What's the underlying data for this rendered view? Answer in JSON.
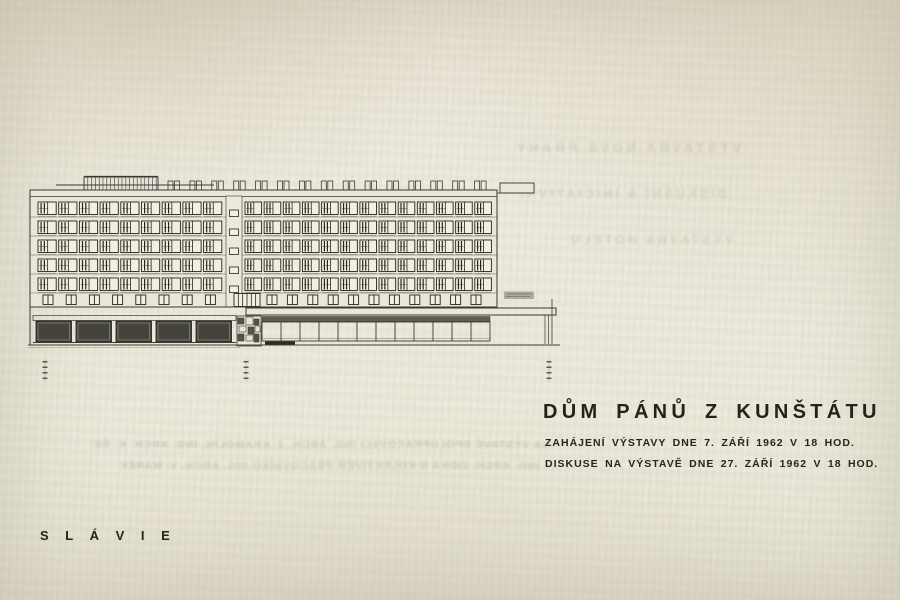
{
  "document": {
    "title": "DŮM PÁNŮ Z KUNŠTÁTU",
    "subtitle_lines": [
      "ZAHÁJENÍ VÝSTAVY DNE 7. ZÁŘÍ 1962 V 18 HOD.",
      "DISKUSE NA VÝSTAVĚ DNE 27. ZÁŘÍ 1962 V 18 HOD."
    ],
    "footer_label": "S L Á V I E"
  },
  "bleedthrough": {
    "top_lines": [
      "VÝSTAVBA NOVÉ PRAHY",
      "DISKUSNÍ A INICIATIVNÍ",
      "VÝSTAVBA HOTELU"
    ],
    "bottom_lines": [
      "NA VÝSTAVĚ SPOLUPRACOVALI ING. ARCH. J. KRAMOLÍN, ING. ARCH. K. ŘEPA,",
      "ING. ARCH. ZÍDKA S KOLEKTIVEM PRACOVNÍKŮ ING. ARCH. V. MAREK"
    ]
  },
  "drawing": {
    "subject": "building-elevation-hotel-slavie",
    "floors": 5,
    "left_windows": 9,
    "right_windows": 13,
    "shaft_windows": 5,
    "mezzanine_left": 8,
    "mezzanine_right": 11,
    "storefronts": 5,
    "arcade_bays": 12,
    "roof_vent_pairs": 15,
    "entrance_mullions": 5,
    "dimension_marks_x": [
      45,
      246,
      549
    ],
    "colors": {
      "line": "#3b3a33",
      "dark": "#26261f",
      "glass": "#f1eee2",
      "wall": "#eae6d8",
      "shaft": "#ece9dc",
      "shade": "#45443c",
      "base_dark": "#2c2b26",
      "sign": "#a6a292",
      "ground": "#3f3e36"
    }
  },
  "colors": {
    "paper": "#e9e5d8",
    "ink": "#23231d"
  }
}
